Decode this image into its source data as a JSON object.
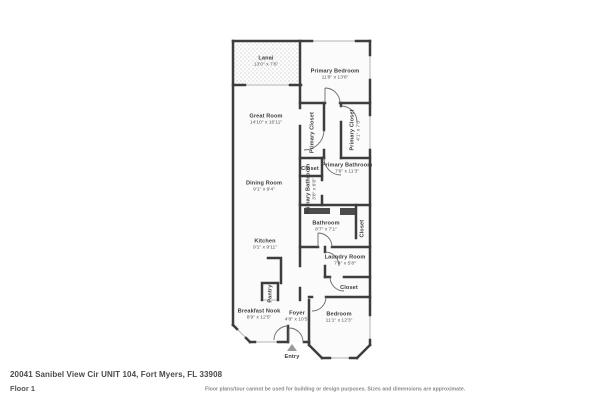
{
  "footer": {
    "address": "20041 Sanibel View Cir UNIT 104, Fort Myers, FL 33908",
    "floor": "Floor 1",
    "disclaimer": "Floor plans/tour cannot be used for building or design purposes. Sizes and dimensions are approximate."
  },
  "colors": {
    "wall": "#3d3d3d",
    "room_fill": "#fbfbfb",
    "window": "#b3b3b3",
    "fixture": "#4c4c4c"
  },
  "rooms": {
    "lanai": {
      "name": "Lanai",
      "dims": "13'0\" x 7'6\""
    },
    "primary_bedroom": {
      "name": "Primary Bedroom",
      "dims": "11'8\" x 13'8\""
    },
    "great_room": {
      "name": "Great Room",
      "dims": "14'10\" x 16'11\""
    },
    "primary_closet_left": {
      "name": "Primary Closet"
    },
    "primary_closet_right": {
      "name": "Primary Closet",
      "dims": "4'1\" x 7'5\""
    },
    "closet_primary_bath": {
      "name": "Closet"
    },
    "primary_bathroom": {
      "name": "Primary Bathroom",
      "dims": "7'6\" x 11'3\""
    },
    "primary_bathroom_small": {
      "name": "Primary Bathroom",
      "dims": "3'8\" x 6'8\""
    },
    "dining_room": {
      "name": "Dining Room",
      "dims": "9'1\" x 9'4\""
    },
    "bathroom": {
      "name": "Bathroom",
      "dims": "8'7\" x 7'1\""
    },
    "closet_bathroom": {
      "name": "Closet"
    },
    "kitchen": {
      "name": "Kitchen",
      "dims": "9'1\" x 9'11\""
    },
    "pantry": {
      "name": "Pantry"
    },
    "laundry_room": {
      "name": "Laundry Room",
      "dims": "7'4\" x 5'8\""
    },
    "closet_laundry": {
      "name": "Closet"
    },
    "breakfast_nook": {
      "name": "Breakfast Nook",
      "dims": "8'9\" x 12'5\""
    },
    "foyer": {
      "name": "Foyer",
      "dims": "4'8\" x 10'5\""
    },
    "bedroom": {
      "name": "Bedroom",
      "dims": "11'1\" x 12'3\""
    },
    "entry": {
      "name": "Entry"
    }
  }
}
